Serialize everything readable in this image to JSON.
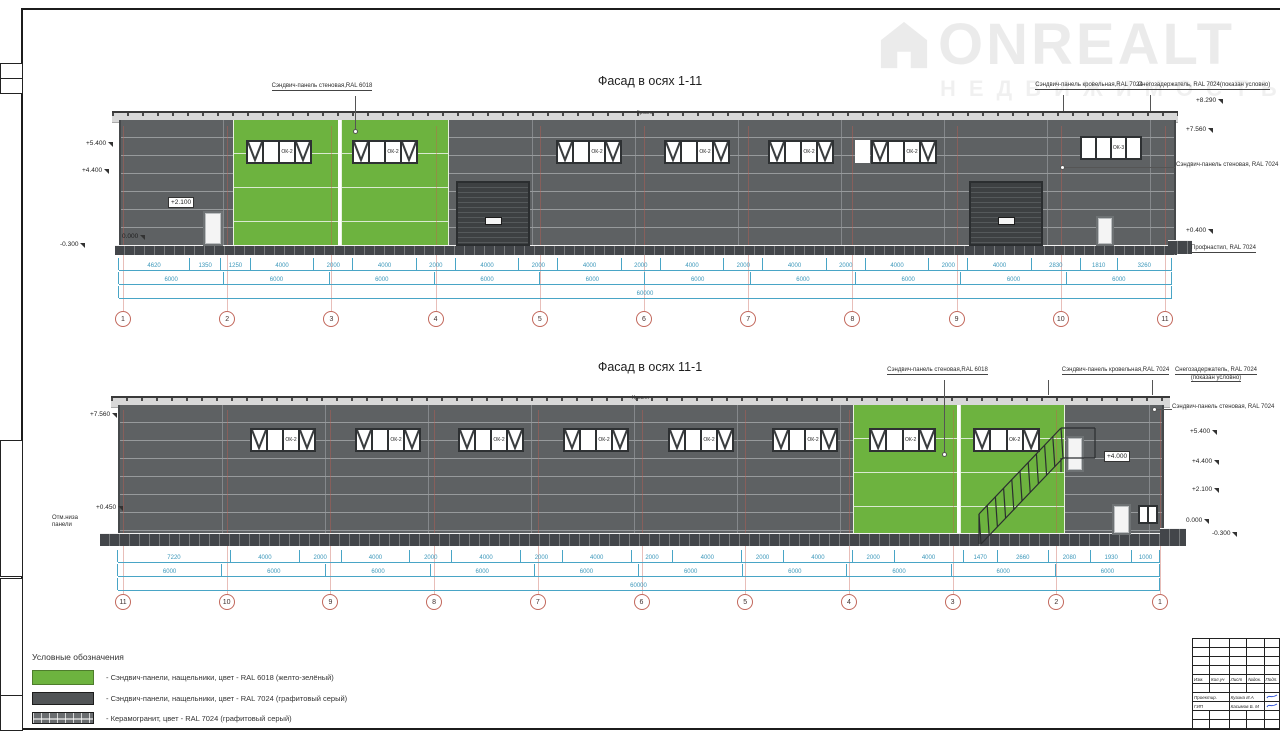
{
  "logo": {
    "brand": "ONREALT",
    "subtitle": "НЕДВИЖИМОСТЬ"
  },
  "colors": {
    "green_ral6018": "#6db33f",
    "gray_ral7024": "#55585a",
    "dim_blue": "#44a0c4",
    "axis_red": "#c4574b"
  },
  "legend": {
    "title": "Условные обозначения",
    "items": [
      {
        "swatch": "green",
        "label": "- Сэндвич-панели, нащельники, цвет - RAL 6018 (желто-зелёный)"
      },
      {
        "swatch": "gray",
        "label": "- Сэндвич-панели, нащельники, цвет - RAL 7024 (графитовый серый)"
      },
      {
        "swatch": "hatch",
        "label": "- Керамогранит, цвет - RAL 7024 (графитовый серый)"
      }
    ]
  },
  "titleblock": {
    "header": [
      "Изм.",
      "Кол.уч",
      "Лист",
      "№док.",
      "Подп."
    ],
    "rows": [
      {
        "role": "Проектир.",
        "name": "Кузина И.А",
        "sig": true
      },
      {
        "role": "ГИП",
        "name": "Касимов Б. М",
        "sig": true
      }
    ]
  },
  "facades": [
    {
      "id": "1-11",
      "title": "Фасад в осях 1-11",
      "roof_label": "Кровля",
      "axes": [
        "1",
        "2",
        "3",
        "4",
        "5",
        "6",
        "7",
        "8",
        "9",
        "10",
        "11"
      ],
      "dims": [
        [
          "4620",
          "1350",
          "1250",
          "4000",
          "2000",
          "4000",
          "2000",
          "4000",
          "2000",
          "4000",
          "2000",
          "4000",
          "2000",
          "4000",
          "2000",
          "4000",
          "2000",
          "4000",
          "2830",
          "1810",
          "3260"
        ],
        [
          "6000",
          "6000",
          "6000",
          "6000",
          "6000",
          "6000",
          "6000",
          "6000",
          "6000",
          "6000"
        ],
        [
          "60000"
        ]
      ],
      "windows": [
        {
          "x": 246,
          "y": 140,
          "w": 66,
          "h": 24,
          "label": "ОК-2",
          "panes": "x-lx"
        },
        {
          "x": 352,
          "y": 140,
          "w": 66,
          "h": 24,
          "label": "ОК-2",
          "panes": "x-lx"
        },
        {
          "x": 556,
          "y": 140,
          "w": 66,
          "h": 24,
          "label": "ОК-2",
          "panes": "x-lx"
        },
        {
          "x": 664,
          "y": 140,
          "w": 66,
          "h": 24,
          "label": "ОК-2",
          "panes": "x-lx"
        },
        {
          "x": 768,
          "y": 140,
          "w": 66,
          "h": 24,
          "label": "ОК-2",
          "panes": "x-lx"
        },
        {
          "x": 871,
          "y": 140,
          "w": 66,
          "h": 24,
          "label": "ОК-2",
          "panes": "x-lx"
        },
        {
          "x": 1080,
          "y": 136,
          "w": 62,
          "h": 24,
          "label": "ОК-3",
          "panes": "--l-"
        }
      ],
      "ann": [
        {
          "lines": [
            "Сэндвич-панель стеновая,",
            "RAL 6018"
          ],
          "x": 262,
          "y": 83,
          "w": 120,
          "u": true,
          "lead": {
            "x": 355,
            "y": 96,
            "w": 1,
            "h": 34
          },
          "dot": {
            "x": 353,
            "y": 129
          }
        },
        {
          "lines": [
            "Сэндвич-панель кровельная,",
            "RAL 7024"
          ],
          "x": 1030,
          "y": 82,
          "w": 118,
          "u": true,
          "lead": {
            "x": 1063,
            "y": 95,
            "w": 1,
            "h": 16
          }
        },
        {
          "lines": [
            "Снегозадержатель, RAL 7024",
            "(показан условно)"
          ],
          "x": 1134,
          "y": 82,
          "w": 140,
          "u": true,
          "lead": {
            "x": 1150,
            "y": 95,
            "w": 1,
            "h": 16
          }
        },
        {
          "lines": [
            "Сэндвич-панель стеновая, RAL 7024"
          ],
          "x": 1176,
          "y": 162,
          "w": 108,
          "left": true,
          "lead": {
            "x": 1063,
            "y": 167,
            "w": 112,
            "h": 1
          },
          "dot": {
            "x": 1060,
            "y": 165
          }
        },
        {
          "lines": [
            "Профнастил, RAL 7024"
          ],
          "x": 1191,
          "y": 245,
          "w": 86,
          "left": true,
          "u": true
        }
      ],
      "elev": [
        {
          "t": "+5.400",
          "x": 86,
          "y": 140
        },
        {
          "t": "+4.400",
          "x": 82,
          "y": 167
        },
        {
          "t": "+2.100",
          "x": 168,
          "y": 197,
          "boxed": true
        },
        {
          "t": "0.000",
          "x": 122,
          "y": 233
        },
        {
          "t": "-0.300",
          "x": 60,
          "y": 241
        },
        {
          "t": "+8.290",
          "x": 1196,
          "y": 97
        },
        {
          "t": "+7.560",
          "x": 1186,
          "y": 126
        },
        {
          "t": "+0.400",
          "x": 1186,
          "y": 227
        }
      ],
      "geom": {
        "roof": {
          "x": 112,
          "y": 111,
          "w": 1066,
          "h": 9
        },
        "wall": {
          "x": 119,
          "y": 120,
          "w": 1053,
          "h": 126
        },
        "plinth": {
          "x": 115,
          "y": 245,
          "w": 1062,
          "h": 9
        },
        "ramp": {
          "x": 1168,
          "y": 240,
          "w": 24,
          "h": 13
        },
        "green": [
          {
            "x": 233,
            "y": 120,
            "w": 105,
            "h": 125
          },
          {
            "x": 341,
            "y": 120,
            "w": 106,
            "h": 125
          }
        ],
        "patches": [
          {
            "x": 338,
            "y": 120,
            "w": 3,
            "h": 125
          },
          {
            "x": 855,
            "y": 140,
            "w": 15,
            "h": 23
          }
        ],
        "doors": [
          {
            "x": 203,
            "y": 211,
            "w": 20,
            "h": 35
          },
          {
            "x": 1096,
            "y": 216,
            "w": 18,
            "h": 30
          }
        ],
        "gates": [
          {
            "x": 456,
            "y": 181,
            "w": 74,
            "h": 65
          },
          {
            "x": 969,
            "y": 181,
            "w": 74,
            "h": 65
          }
        ],
        "dims": {
          "x": 119,
          "w": 1053,
          "rows": [
            {
              "y": 258,
              "h": 13
            },
            {
              "y": 272,
              "h": 13
            },
            {
              "y": 286,
              "h": 13
            }
          ]
        },
        "axes": {
          "x1": 123,
          "x2": 1165,
          "y": 311,
          "lineTop": 126
        }
      }
    },
    {
      "id": "11-1",
      "title": "Фасад в осях 11-1",
      "roof_label": "Кровля",
      "axes": [
        "11",
        "10",
        "9",
        "8",
        "7",
        "6",
        "5",
        "4",
        "3",
        "2",
        "1"
      ],
      "dims": [
        [
          "7220",
          "4000",
          "2000",
          "4000",
          "2000",
          "4000",
          "2000",
          "4000",
          "2000",
          "4000",
          "2000",
          "4000",
          "2000",
          "4000",
          "1470",
          "2660",
          "2080",
          "1930",
          "1000"
        ],
        [
          "6000",
          "6000",
          "6000",
          "6000",
          "6000",
          "6000",
          "6000",
          "6000",
          "6000",
          "6000"
        ],
        [
          "60000"
        ]
      ],
      "windows": [
        {
          "x": 250,
          "y": 428,
          "w": 66,
          "h": 24,
          "label": "ОК-2",
          "panes": "x-lx"
        },
        {
          "x": 355,
          "y": 428,
          "w": 66,
          "h": 24,
          "label": "ОК-2",
          "panes": "x-lx"
        },
        {
          "x": 458,
          "y": 428,
          "w": 66,
          "h": 24,
          "label": "ОК-2",
          "panes": "x-lx"
        },
        {
          "x": 563,
          "y": 428,
          "w": 66,
          "h": 24,
          "label": "ОК-2",
          "panes": "x-lx"
        },
        {
          "x": 668,
          "y": 428,
          "w": 66,
          "h": 24,
          "label": "ОК-2",
          "panes": "x-lx"
        },
        {
          "x": 772,
          "y": 428,
          "w": 66,
          "h": 24,
          "label": "ОК-2",
          "panes": "x-lx"
        },
        {
          "x": 869,
          "y": 428,
          "w": 67,
          "h": 24,
          "label": "ОК-2",
          "panes": "x-lx"
        },
        {
          "x": 973,
          "y": 428,
          "w": 67,
          "h": 24,
          "label": "ОК-2",
          "panes": "x-lx"
        },
        {
          "x": 1138,
          "y": 505,
          "w": 20,
          "h": 19,
          "label": "",
          "panes": "--"
        }
      ],
      "ann": [
        {
          "lines": [
            "Сэндвич-панель стеновая,",
            "RAL 6018"
          ],
          "x": 880,
          "y": 367,
          "w": 115,
          "u": true,
          "lead": {
            "x": 944,
            "y": 380,
            "w": 1,
            "h": 72
          },
          "dot": {
            "x": 942,
            "y": 452
          }
        },
        {
          "lines": [
            "Сэндвич-панель кровельная,",
            "RAL 7024"
          ],
          "x": 1058,
          "y": 367,
          "w": 115,
          "u": true,
          "lead": {
            "x": 1048,
            "y": 380,
            "w": 1,
            "h": 15
          }
        },
        {
          "lines": [
            "Снегозадержатель, RAL 7024",
            "(показан условно)"
          ],
          "x": 1156,
          "y": 367,
          "w": 120,
          "u": true,
          "lead": {
            "x": 1152,
            "y": 380,
            "w": 1,
            "h": 15
          }
        },
        {
          "lines": [
            "Сэндвич-панель стеновая, RAL 7024"
          ],
          "x": 1172,
          "y": 404,
          "w": 108,
          "left": true,
          "lead": {
            "x": 1156,
            "y": 409,
            "w": 16,
            "h": 1
          },
          "dot": {
            "x": 1152,
            "y": 407
          }
        },
        {
          "lines": [
            "Отм.низа",
            "панели"
          ],
          "x": 52,
          "y": 515,
          "w": 40,
          "left": true
        }
      ],
      "elev": [
        {
          "t": "+7.560",
          "x": 90,
          "y": 411
        },
        {
          "t": "+0.450",
          "x": 96,
          "y": 504
        },
        {
          "t": "+5.400",
          "x": 1190,
          "y": 428
        },
        {
          "t": "+4.400",
          "x": 1192,
          "y": 458
        },
        {
          "t": "+2.100",
          "x": 1192,
          "y": 486
        },
        {
          "t": "0.000",
          "x": 1186,
          "y": 517
        },
        {
          "t": "-0.300",
          "x": 1212,
          "y": 530
        },
        {
          "t": "+4.000",
          "x": 1104,
          "y": 451,
          "boxed": true
        }
      ],
      "geom": {
        "roof": {
          "x": 111,
          "y": 396,
          "w": 1059,
          "h": 9
        },
        "wall": {
          "x": 118,
          "y": 405,
          "w": 1042,
          "h": 130
        },
        "plinth": {
          "x": 100,
          "y": 533,
          "w": 1086,
          "h": 12
        },
        "ramp": {
          "x": 1160,
          "y": 528,
          "w": 26,
          "h": 9
        },
        "green": [
          {
            "x": 853,
            "y": 405,
            "w": 104,
            "h": 129
          },
          {
            "x": 960,
            "y": 405,
            "w": 103,
            "h": 129
          }
        ],
        "patches": [
          {
            "x": 957,
            "y": 405,
            "w": 3,
            "h": 129
          }
        ],
        "doors": [
          {
            "x": 1066,
            "y": 436,
            "w": 18,
            "h": 36
          },
          {
            "x": 1112,
            "y": 504,
            "w": 19,
            "h": 31
          }
        ],
        "gates": [],
        "dims": {
          "x": 118,
          "w": 1042,
          "rows": [
            {
              "y": 550,
              "h": 13
            },
            {
              "y": 564,
              "h": 13
            },
            {
              "y": 578,
              "h": 13
            }
          ]
        },
        "axes": {
          "x1": 123,
          "x2": 1160,
          "y": 594,
          "lineTop": 410
        },
        "stairs": {
          "x": 965,
          "y": 412,
          "w": 140,
          "h": 136,
          "rail": [
            14,
            102,
            96,
            16
          ],
          "stringer": [
            16,
            132,
            98,
            46
          ],
          "extra": [
            [
              96,
              16,
              130,
              16
            ],
            [
              98,
              46,
              130,
              46
            ],
            [
              130,
              16,
              130,
              46
            ],
            [
              14,
              102,
              14,
              132
            ],
            [
              96,
              46,
              96,
              60
            ]
          ]
        }
      }
    }
  ]
}
